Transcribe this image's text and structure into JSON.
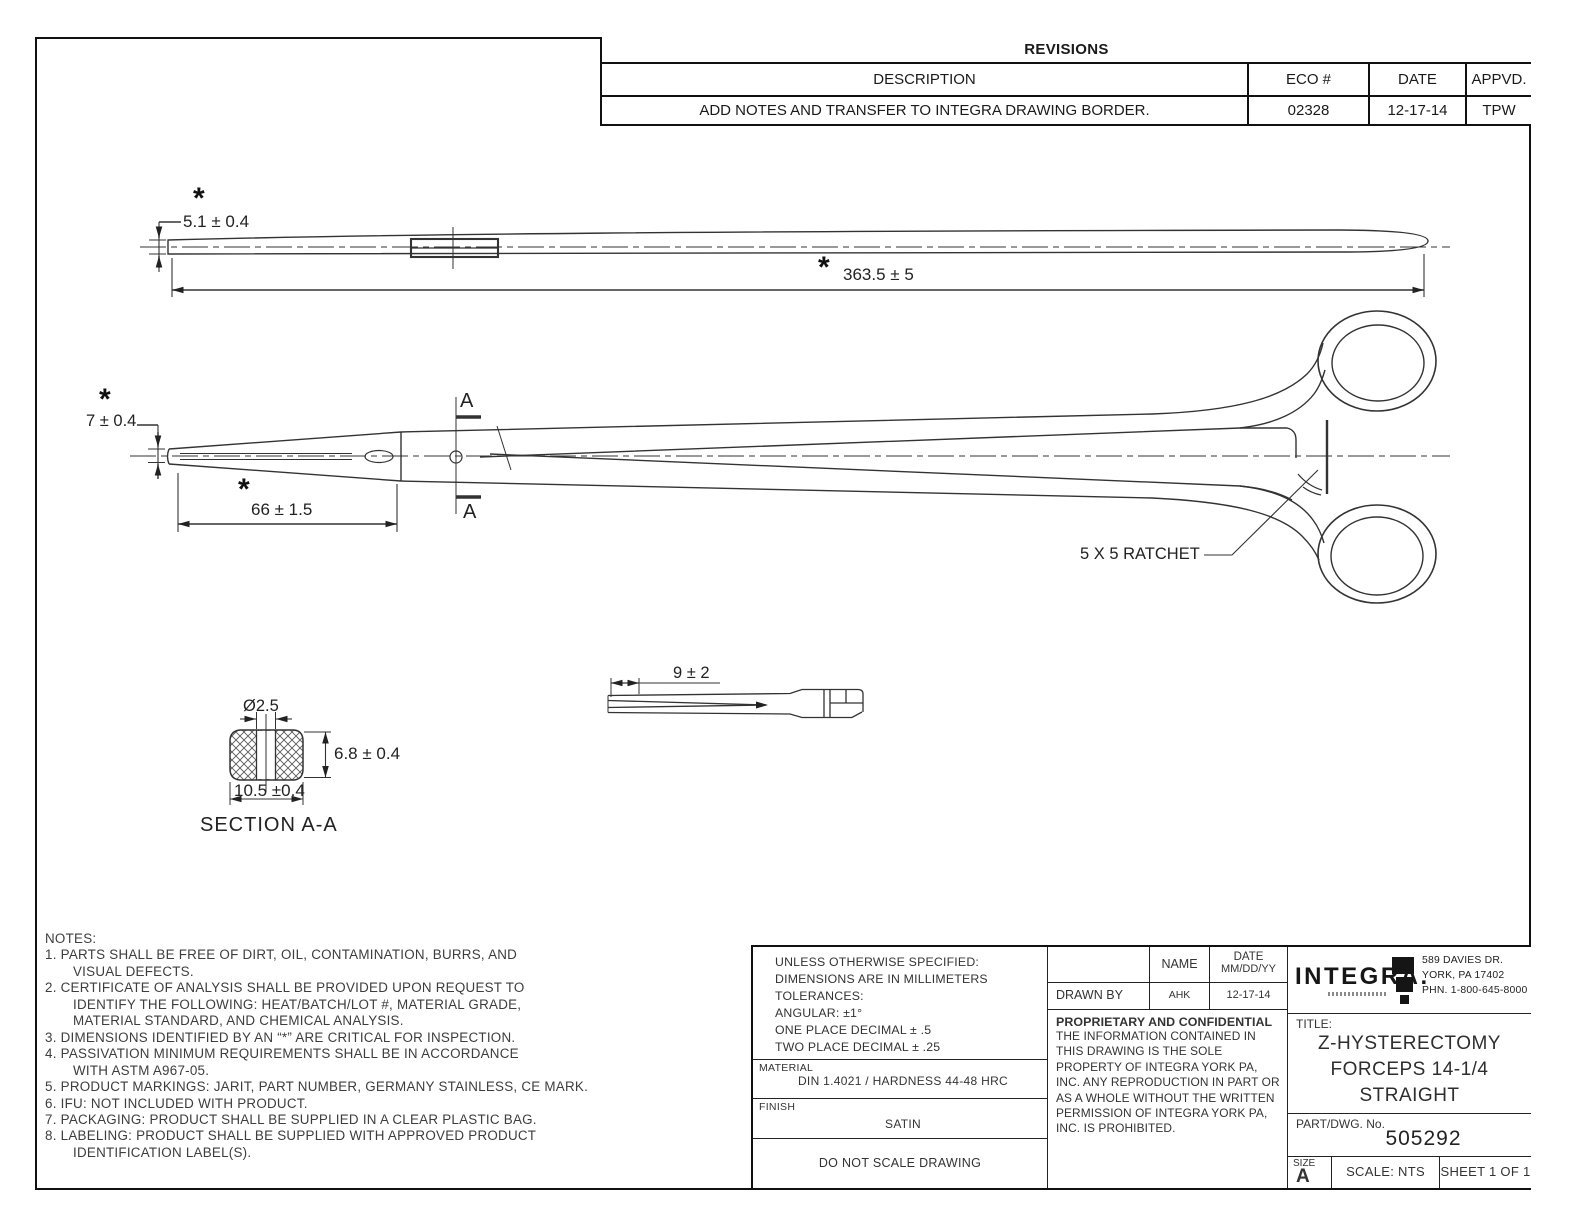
{
  "revisions_table": {
    "title": "REVISIONS",
    "headers": {
      "description": "DESCRIPTION",
      "eco": "ECO #",
      "date": "DATE",
      "approved": "APPVD."
    },
    "rows": [
      {
        "description": "ADD NOTES AND TRANSFER TO INTEGRA DRAWING BORDER.",
        "eco": "02328",
        "date": "12-17-14",
        "approved": "TPW"
      }
    ]
  },
  "critical_marker": "*",
  "views": {
    "top": {
      "height_dim": "5.1 ± 0.4",
      "length_dim": "363.5 ± 5"
    },
    "side": {
      "tip_height_dim": "7 ± 0.4",
      "jaw_length_dim": "66 ± 1.5",
      "ratchet_label": "5 X 5 RATCHET",
      "section_letter": "A"
    },
    "tip_detail": {
      "serration_dim": "9 ± 2"
    },
    "section": {
      "title": "SECTION A-A",
      "hole_dim": "Ø2.5",
      "height_dim": "6.8 ± 0.4",
      "width_dim": "10.5 ±0.4"
    }
  },
  "notes": {
    "lines": [
      {
        "t": "NOTES:"
      },
      {
        "t": "1.  PARTS SHALL BE FREE OF DIRT, OIL, CONTAMINATION, BURRS, AND"
      },
      {
        "t": "VISUAL DEFECTS."
      },
      {
        "t": "2.  CERTIFICATE OF ANALYSIS SHALL BE PROVIDED UPON REQUEST TO"
      },
      {
        "t": "IDENTIFY THE FOLLOWING: HEAT/BATCH/LOT #, MATERIAL GRADE,"
      },
      {
        "t": "MATERIAL STANDARD, AND CHEMICAL ANALYSIS."
      },
      {
        "t": "3.  DIMENSIONS IDENTIFIED BY AN “*” ARE CRITICAL FOR INSPECTION."
      },
      {
        "t": "4.  PASSIVATION MINIMUM REQUIREMENTS SHALL BE IN ACCORDANCE"
      },
      {
        "t": "WITH ASTM A967-05."
      },
      {
        "t": "5.  PRODUCT MARKINGS: JARIT, PART NUMBER, GERMANY STAINLESS, CE MARK."
      },
      {
        "t": "6.  IFU: NOT INCLUDED WITH PRODUCT."
      },
      {
        "t": "7.  PACKAGING: PRODUCT  SHALL BE SUPPLIED IN A CLEAR PLASTIC BAG."
      },
      {
        "t": "8.  LABELING: PRODUCT SHALL BE SUPPLIED WITH APPROVED PRODUCT"
      },
      {
        "t": "IDENTIFICATION LABEL(S)."
      }
    ]
  },
  "title_block": {
    "tolerances": {
      "l1": "UNLESS OTHERWISE SPECIFIED:",
      "l2": "DIMENSIONS ARE IN MILLIMETERS",
      "l3": "TOLERANCES:",
      "l4": "ANGULAR: ±1°",
      "l5": "ONE PLACE DECIMAL ± .5",
      "l6": "TWO PLACE DECIMAL ± .25"
    },
    "material": {
      "label": "MATERIAL",
      "value": "DIN 1.4021 / HARDNESS 44-48 HRC"
    },
    "finish": {
      "label": "FINISH",
      "value": "SATIN"
    },
    "do_not_scale": "DO NOT SCALE DRAWING",
    "sign_table": {
      "name_header": "NAME",
      "date_header_1": "DATE",
      "date_header_2": "MM/DD/YY",
      "drawn_by_label": "DRAWN BY",
      "drawn_by_name": "AHK",
      "drawn_by_date": "12-17-14"
    },
    "proprietary": {
      "title": "PROPRIETARY AND CONFIDENTIAL",
      "body": "THE INFORMATION CONTAINED IN THIS DRAWING IS THE SOLE PROPERTY OF INTEGRA YORK PA, INC.  ANY REPRODUCTION IN PART OR AS A WHOLE WITHOUT THE WRITTEN PERMISSION OF INTEGRA YORK PA, INC. IS PROHIBITED."
    },
    "company": {
      "logo_text": "INTEGRA.",
      "address_1": "589 DAVIES DR.",
      "address_2": "YORK, PA 17402",
      "address_3": "PHN. 1-800-645-8000"
    },
    "title": {
      "label": "TITLE:",
      "line1": "Z-HYSTERECTOMY",
      "line2": "FORCEPS 14-1/4",
      "line3": "STRAIGHT"
    },
    "part": {
      "label": "PART/DWG. No.",
      "value": "505292"
    },
    "size": {
      "label": "SIZE",
      "value": "A"
    },
    "scale": "SCALE: NTS",
    "sheet": "SHEET 1 OF 1"
  }
}
